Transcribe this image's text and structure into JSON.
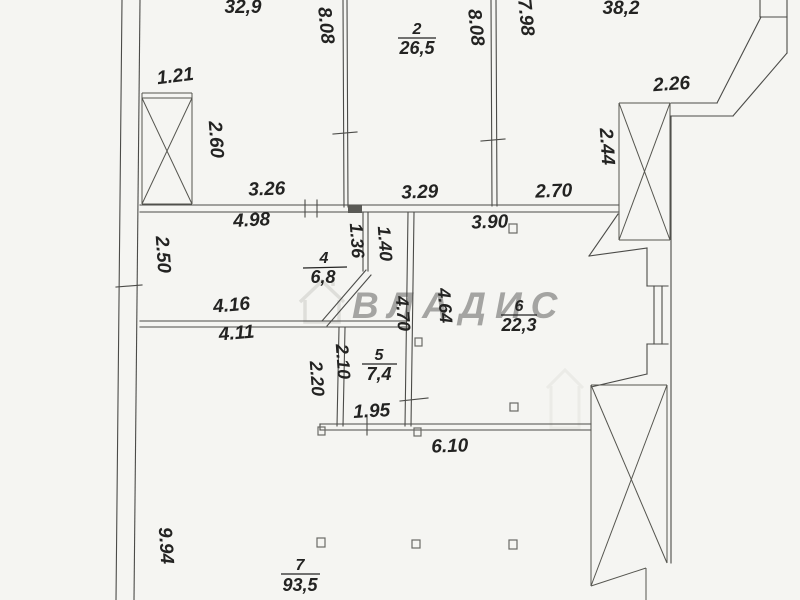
{
  "document": {
    "type": "floor-plan-scan",
    "watermark_text": "ВЛАДИС"
  },
  "rooms": [
    {
      "number": "2",
      "area": "26,5"
    },
    {
      "number": "4",
      "area": "6,8"
    },
    {
      "number": "5",
      "area": "7,4"
    },
    {
      "number": "6",
      "area": "22,3"
    },
    {
      "number": "7",
      "area": "93,5"
    }
  ],
  "partial_area_labels": [
    {
      "area": "32,9"
    },
    {
      "area": "38,2"
    }
  ],
  "dimensions": [
    "8.08",
    "8.08",
    "7.98",
    "1.21",
    "2.26",
    "2.60",
    "2.44",
    "3.26",
    "3.29",
    "2.70",
    "4.98",
    "1.36",
    "1.40",
    "3.90",
    "2.50",
    "4.16",
    "4.11",
    "2.20",
    "2.10",
    "4.70",
    "4.64",
    "1.95",
    "6.10",
    "9.94"
  ]
}
